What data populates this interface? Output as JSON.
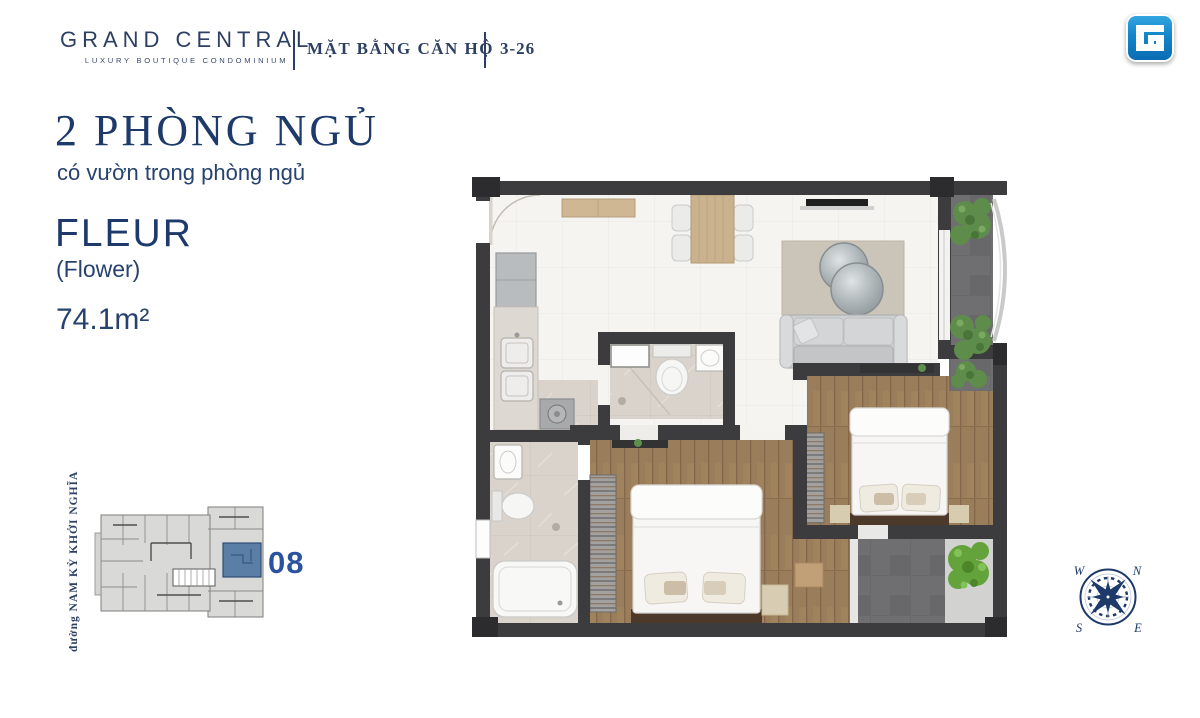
{
  "header": {
    "brand": "GRAND CENTRAL",
    "brand_tagline": "LUXURY BOUTIQUE CONDOMINIUM",
    "section_title": "MẶT BẰNG CĂN HỘ",
    "unit_range": "3-26",
    "logo_letter": "G"
  },
  "unit_info": {
    "title": "2 PHÒNG NGỦ",
    "subtitle": "có vườn trong phòng ngủ",
    "name": "FLEUR",
    "name_translation": "(Flower)",
    "area": "74.1m²"
  },
  "key_plan": {
    "unit_number": "08",
    "street_label": "đường NAM KỲ KHỞI NGHĨA",
    "highlight_color": "#5b7ea6"
  },
  "compass": {
    "north": "N",
    "east": "E",
    "south": "S",
    "west": "W"
  },
  "colors": {
    "navy_text": "#1d3a6b",
    "unit_number_blue": "#2b529e",
    "wall": "#3c3b3d",
    "wood_floor": "#9a7d5a",
    "logo_blue_top": "#36a9e2",
    "logo_blue_bottom": "#0b6ab1"
  }
}
